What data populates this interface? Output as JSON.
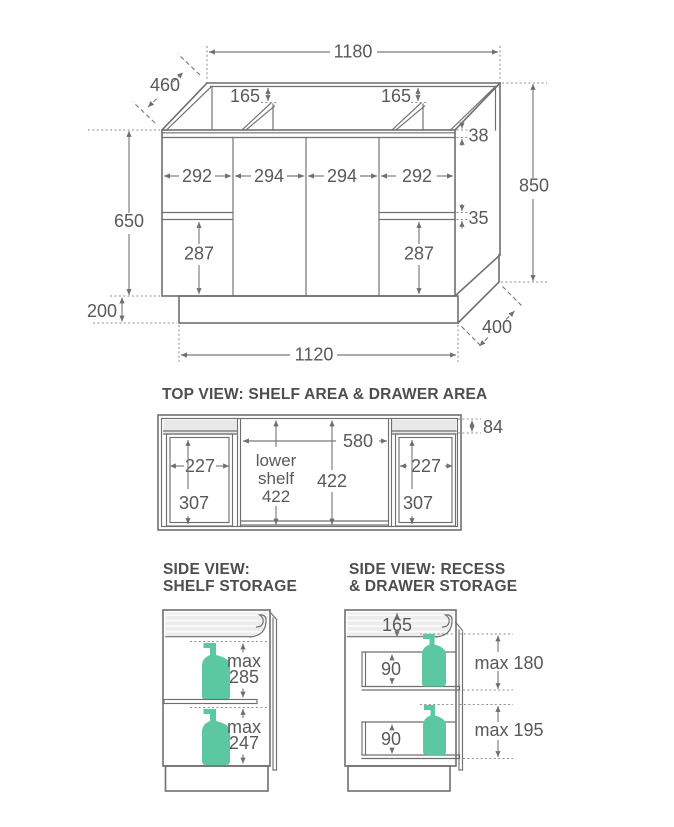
{
  "colors": {
    "line": "#6f6f6f",
    "dim_text": "#595959",
    "title_text": "#4e4e4e",
    "accent_green": "#5bc8a2",
    "panel_gray": "#e8e8e8"
  },
  "main_view": {
    "dim_top_width": "1180",
    "dim_depth": "460",
    "dim_recess_left": "165",
    "dim_recess_right": "165",
    "dim_top_rail": "38",
    "dim_total_height": "850",
    "door_widths": [
      "292",
      "294",
      "294",
      "292"
    ],
    "dim_drawer_gap": "35",
    "dim_body_height": "650",
    "dim_drawer_front_left": "287",
    "dim_drawer_front_right": "287",
    "dim_kick_height": "200",
    "dim_kick_width": "1120",
    "dim_kick_depth": "400"
  },
  "top_view": {
    "title": "TOP VIEW: SHELF AREA & DRAWER AREA",
    "dim_back_strip": "84",
    "dim_shelf_width": "580",
    "dim_left_drawer_width": "227",
    "dim_right_drawer_width": "227",
    "dim_left_drawer_depth": "307",
    "dim_right_drawer_depth": "307",
    "shelf_label_line1": "lower",
    "shelf_label_line2": "shelf",
    "shelf_label_value": "422",
    "dim_shelf_depth": "422"
  },
  "side_view_shelf": {
    "title_line1": "SIDE VIEW:",
    "title_line2": "SHELF STORAGE",
    "upper_max_word": "max",
    "upper_max_value": "285",
    "lower_max_word": "max",
    "lower_max_value": "247"
  },
  "side_view_drawer": {
    "title_line1": "SIDE VIEW: RECESS",
    "title_line2": "& DRAWER STORAGE",
    "dim_recess_height": "165",
    "dim_upper_drawer_inner": "90",
    "dim_lower_drawer_inner": "90",
    "upper_max": "max 180",
    "lower_max": "max 195"
  }
}
